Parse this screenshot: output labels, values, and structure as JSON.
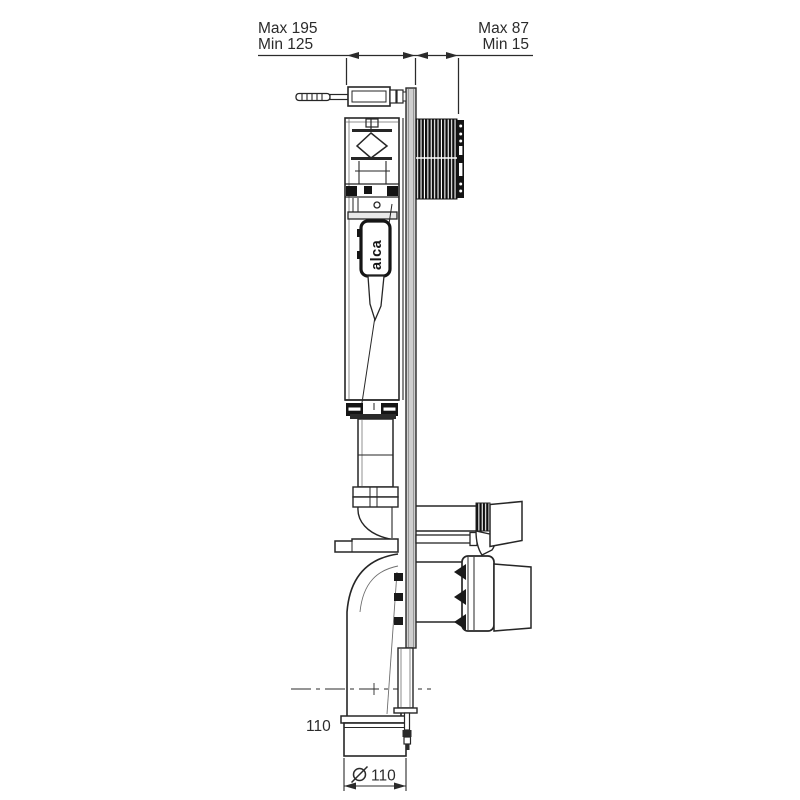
{
  "drawing": {
    "type": "technical-side-view",
    "subject": "concealed-cistern-frame",
    "dimensions": {
      "top_left_max": "Max 195",
      "top_left_min": "Min 125",
      "top_right_max": "Max 87",
      "top_right_min": "Min 15",
      "outlet_height_label": "110",
      "outlet_diameter_label": "⌀110",
      "outlet_diameter_symbol": "⌀",
      "outlet_diameter_number": "110"
    },
    "logo": {
      "text": "alca"
    },
    "colors": {
      "line": "#262626",
      "dark_fill": "#141414",
      "plate_fill": "#cfcfcf",
      "background": "#ffffff"
    }
  }
}
